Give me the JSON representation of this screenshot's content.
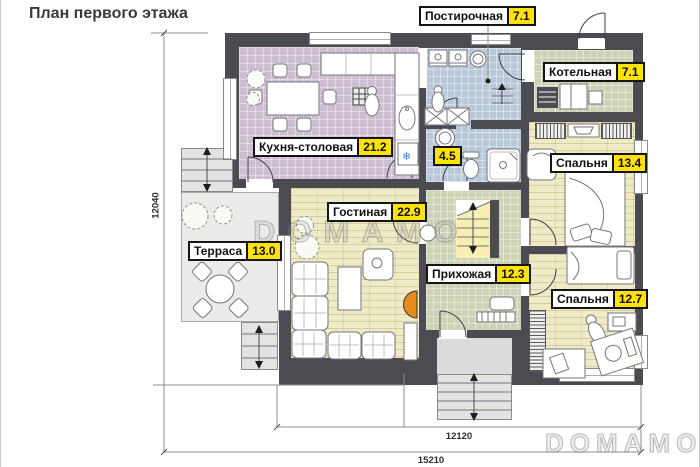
{
  "title": "План первого этажа",
  "watermarks": {
    "center": "DOMAMO",
    "corner": "DOMAMO"
  },
  "dimensions": {
    "height_total": "12040",
    "width_inner": "12120",
    "width_total": "15210"
  },
  "rooms": {
    "kitchen": {
      "name": "Кухня-столовая",
      "area": "21.2"
    },
    "laundry": {
      "name": "Постирочная",
      "area": "7.1"
    },
    "boiler": {
      "name": "Котельная",
      "area": "7.1"
    },
    "bathroom": {
      "area": "4.5"
    },
    "bedroom1": {
      "name": "Спальня",
      "area": "13.4"
    },
    "living": {
      "name": "Гостиная",
      "area": "22.9"
    },
    "hallway": {
      "name": "Прихожая",
      "area": "12.3"
    },
    "bedroom2": {
      "name": "Спальня",
      "area": "12.7"
    },
    "terrace": {
      "name": "Терраса",
      "area": "13.0"
    }
  },
  "icons": {
    "snowflake": "❄"
  },
  "colors": {
    "wall": "#4b4b51",
    "area_badge": "#ffe20a",
    "floor_kitchen": "#cdbfd1",
    "floor_wet": "#b9c8d8",
    "floor_utility": "#ccd3b5",
    "floor_wood": "#f0ebc7",
    "terrace": "#ebebe9",
    "fireplace": "#e8891c"
  }
}
